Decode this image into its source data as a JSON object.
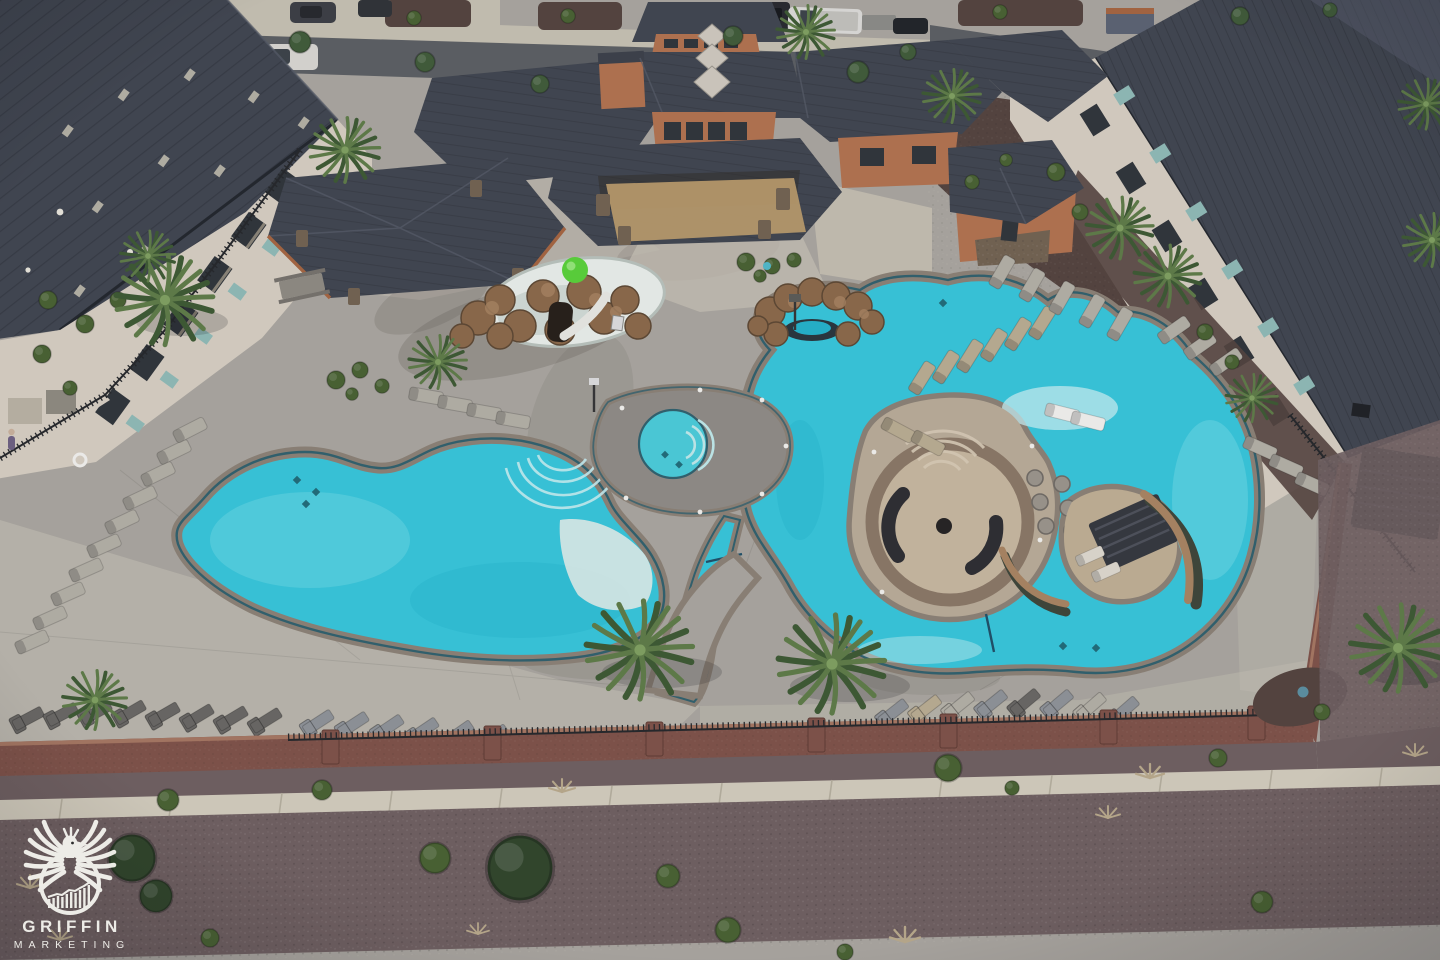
{
  "scene": {
    "caption": "Aerial dusk view of a resort-style community pool area: free-form pool, lazy river with sunken fire-pit island, hot tub, kids splash pad with rock grotto and green sphere, clubhouse and pavilion with dark hip roofs, cream apartment buildings on both sides, rows of lounge chairs, palm trees, iron fence on brick wall, sidewalk and desert gravel landscaping"
  },
  "watermark": {
    "line1": "GRIFFIN",
    "line2": "MARKETING",
    "logo_icon": "griffin-eagle-chart-icon"
  },
  "palette": {
    "water": "#35c6da",
    "water-deep": "#22b2c9",
    "water-light": "#6fd9e5",
    "water-pale": "#c5edf0",
    "shallow": "#e9efe9",
    "deck": "#a9a59d",
    "deck-light": "#c7c2b4",
    "deck-dark": "#8f8b84",
    "coping": "#8b8073",
    "waterline": "#2f5f6b",
    "roof": "#3f444d",
    "roof-light": "#5a6170",
    "roof-rib": "#2b2f37",
    "cream": "#d6cec0",
    "terracotta": "#b2714c",
    "stone": "#71614f",
    "rock": "#8b6847",
    "rock-light": "#a8835f",
    "rock-dark": "#5c4630",
    "green-ball": "#58d136",
    "palm": "#5d7b45",
    "palm-dark": "#3c5830",
    "palm-light": "#7fa05e",
    "bush": "#47602f",
    "gravel": "#6e5e5e",
    "gravel-dark": "#5f4f4b",
    "mulch": "#53423c",
    "sidewalk": "#d2ccbb",
    "street": "#5a5d60",
    "street-light": "#c6c0b0",
    "brick": "#7e5146",
    "brick-light": "#a5755f",
    "fence": "#232527",
    "chair-light": "#b3afa4",
    "chair-tan": "#b9ac90",
    "chair-dark": "#686661",
    "chair-blue": "#8e9296",
    "sofa": "#2c2c2f",
    "white": "#f2f1ec",
    "glass": "#8fbab5",
    "window-dark": "#2e3337",
    "sand": "#bf9e6c"
  }
}
